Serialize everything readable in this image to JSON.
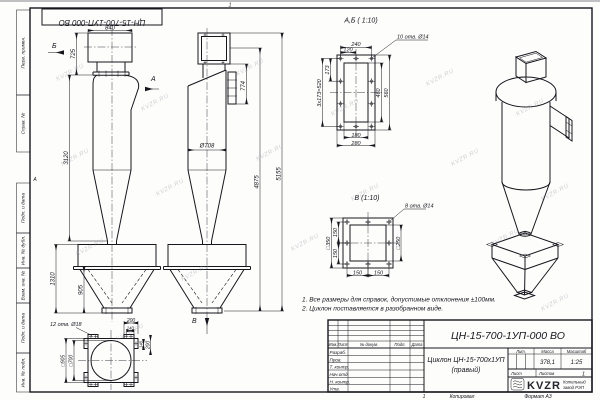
{
  "watermark": "KVZR.RU",
  "frame": {
    "stamp_top": "ЦН-15-700-1УП-000 ВО",
    "zone_a": "А",
    "zone_top": "1",
    "zone_bottom": "1",
    "margin_labels": [
      "Перв. примен.",
      "Справ. №",
      "Подп. и дата",
      "Инв. № дубл.",
      "Взам. инв. №",
      "Подп. и дата",
      "Инв. № подл."
    ]
  },
  "views": {
    "front": {
      "arrow_a": "А",
      "arrow_b": "Б",
      "dim_840": "840",
      "dim_725": "725",
      "dim_3120": "3120",
      "dim_1310": "1310",
      "dim_905": "905"
    },
    "side": {
      "arrow_v": "В",
      "dim_774": "774",
      "dim_d708": "Ø708",
      "dim_4875": "4875",
      "dim_5155": "5155"
    },
    "detail_ab": {
      "title": "А,Б ( 1:10)",
      "holes_note": "10 отв. Ø14",
      "dim_240": "240",
      "dim_120": "120",
      "dim_173": "173",
      "dim_520": "3х173=520",
      "dim_460": "460",
      "dim_560": "560",
      "dim_180": "180",
      "dim_280": "280"
    },
    "detail_v": {
      "title": "В (1:10)",
      "holes_note": "8 отв. Ø14",
      "dim_350": "□350",
      "dim_250": "□250",
      "dim_150a": "150",
      "dim_150b": "150",
      "dim_150c": "150",
      "dim_150d": "150"
    },
    "detail_flange": {
      "holes_note": "12 отв. Ø18",
      "dim_200a": "200",
      "dim_140a": "140",
      "dim_140b": "140",
      "dim_200b": "200",
      "dim_905": "□905",
      "dim_700": "□700"
    }
  },
  "notes": {
    "line1": "1. Все размеры для справок, допустимые отклонения ±100мм.",
    "line2": "2. Циклон поставляется в разобранном виде."
  },
  "title_block": {
    "designation": "ЦН-15-700-1УП-000 ВО",
    "doc_name_line1": "Циклон ЦН-15-700х1УП",
    "doc_name_line2": "(правый)",
    "col_izm": "Изм.",
    "col_list": "Лист",
    "col_doc": "№ докум.",
    "col_podp": "Подп.",
    "col_data": "Дата",
    "row_razrab": "Разраб.",
    "row_prov": "Пров.",
    "row_tkontr": "Т. контр.",
    "row_nachotd": "Нач.отд.",
    "row_nkontr": "Н. контр.",
    "row_utv": "Утв.",
    "lit_label": "Лит.",
    "mass_label": "Масса",
    "scale_label": "Масштаб",
    "mass_value": "378,1",
    "scale_value": "1:25",
    "sheet_label": "Лист",
    "sheets_label": "Листов",
    "sheets_value": "1",
    "logo_text": "KVZR",
    "logo_sub1": "Котельный",
    "logo_sub2": "завод РЭП",
    "kopiroval": "Копировал",
    "format": "Формат А3"
  }
}
